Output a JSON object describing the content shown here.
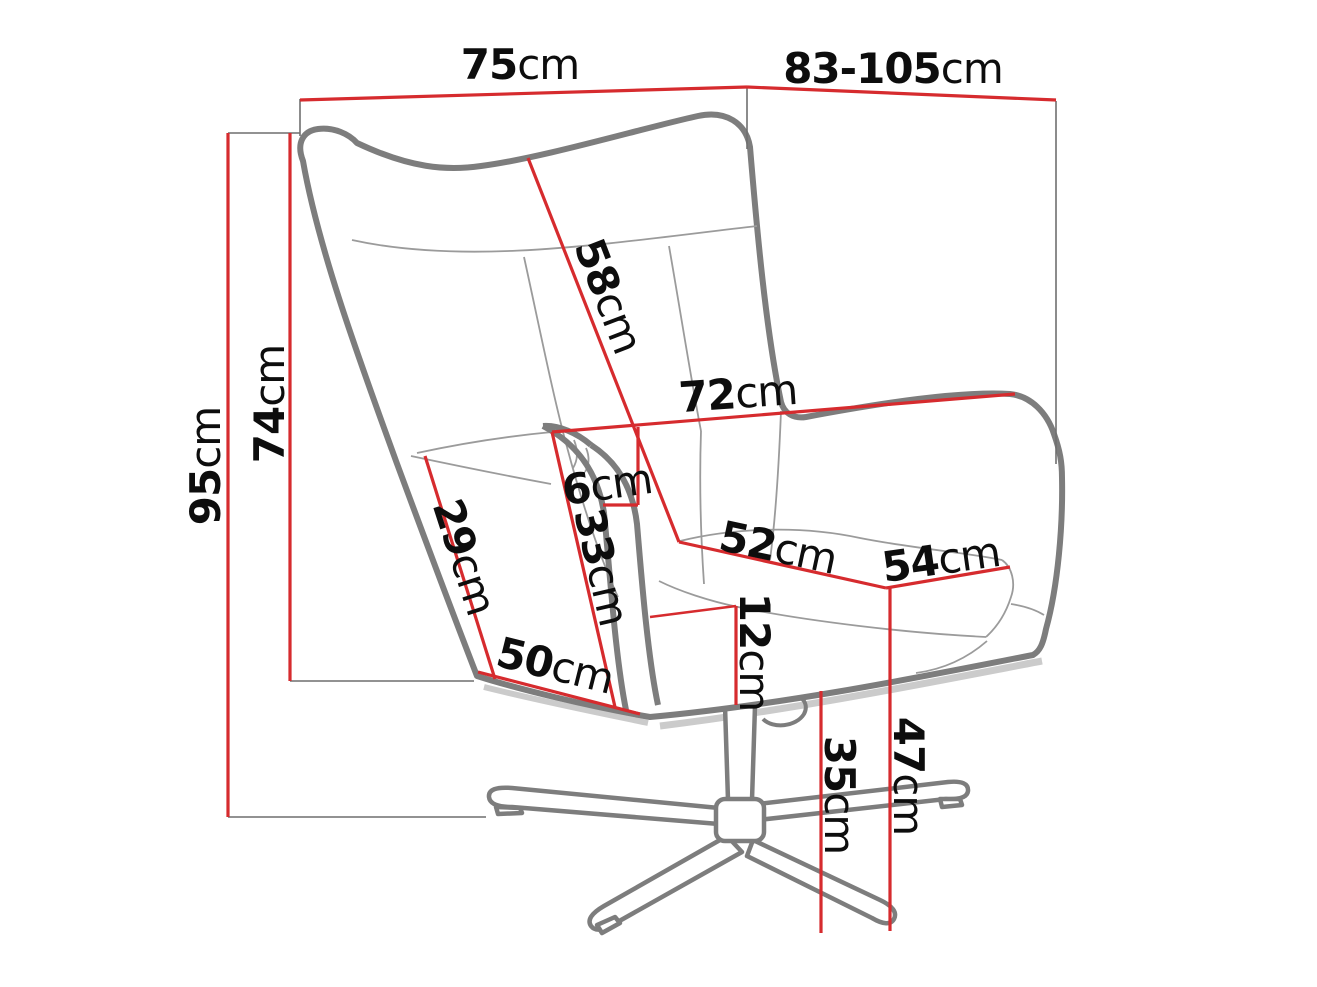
{
  "page": {
    "background": "#ffffff"
  },
  "diagram": {
    "type": "furniture-dimension-diagram",
    "subject": "wingback-swivel-armchair-line-drawing",
    "unit": "cm",
    "dimensions": {
      "width_total": {
        "value": "75",
        "unit": "cm"
      },
      "depth_range": {
        "value": "83-105",
        "unit": "cm"
      },
      "height_total": {
        "value": "95",
        "unit": "cm"
      },
      "height_back": {
        "value": "74",
        "unit": "cm"
      },
      "backrest_diagonal": {
        "value": "58",
        "unit": "cm"
      },
      "backrest_width": {
        "value": "72",
        "unit": "cm"
      },
      "armrest_width": {
        "value": "6",
        "unit": "cm"
      },
      "side_upper": {
        "value": "29",
        "unit": "cm"
      },
      "armrest_height": {
        "value": "33",
        "unit": "cm"
      },
      "seat_width": {
        "value": "52",
        "unit": "cm"
      },
      "seat_depth": {
        "value": "54",
        "unit": "cm"
      },
      "seat_thickness": {
        "value": "12",
        "unit": "cm"
      },
      "side_lower": {
        "value": "50",
        "unit": "cm"
      },
      "base_height": {
        "value": "35",
        "unit": "cm"
      },
      "seat_height": {
        "value": "47",
        "unit": "cm"
      }
    },
    "colors": {
      "dimension_line": "#d62b2e",
      "chair_outline": "#7d7d7d",
      "seam_line": "#9b9b9b",
      "extension_line": "#6f6f6f",
      "label_text": "#0d0d0d",
      "shadow": "#cbcbcb"
    }
  }
}
